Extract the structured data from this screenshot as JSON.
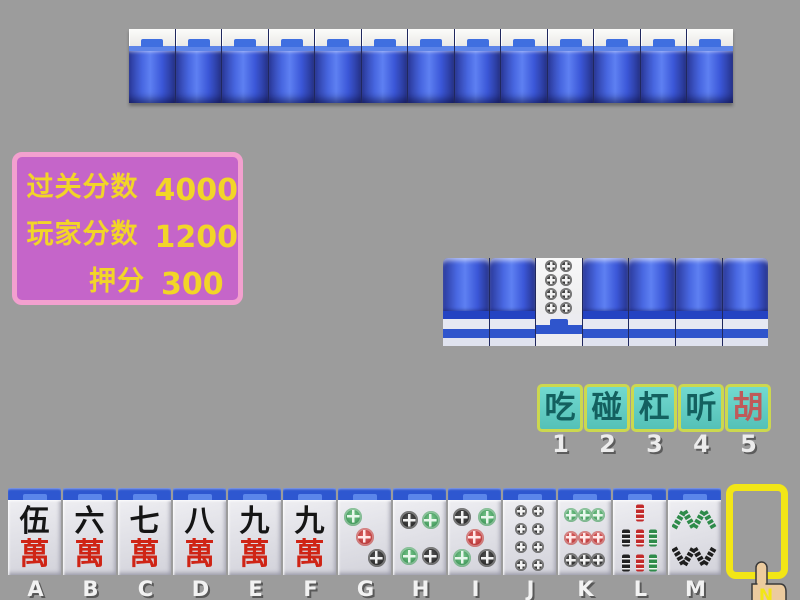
{
  "background_color": "#9c9c9c",
  "palette": {
    "green": "#2e8b4a",
    "red": "#c22a2a",
    "black": "#1d1d1d",
    "tile_blue": "#3b57d8",
    "accent_yellow": "#f2d528",
    "button_border": "#ccd84f",
    "button_fill": "#5fccc2",
    "slot_yellow": "#f2e616",
    "panel_fill": "#c565c9",
    "panel_border": "#f3a0cf"
  },
  "score_panel": {
    "rows": [
      {
        "label": "过关分数",
        "value": "4000"
      },
      {
        "label": "玩家分数",
        "value": "1200"
      },
      {
        "label": "押分",
        "value": "300"
      }
    ]
  },
  "opponent_row": {
    "tile_count": 13
  },
  "meld_row": {
    "tile_count": 7,
    "face_up_index": 3,
    "face_up": {
      "name": "8-dots",
      "dot_size": "small",
      "circles": [
        {
          "x": 33,
          "y": 15,
          "c": "black"
        },
        {
          "x": 66,
          "y": 15,
          "c": "black"
        },
        {
          "x": 33,
          "y": 40,
          "c": "black"
        },
        {
          "x": 66,
          "y": 40,
          "c": "black"
        },
        {
          "x": 33,
          "y": 65,
          "c": "black"
        },
        {
          "x": 66,
          "y": 65,
          "c": "black"
        },
        {
          "x": 33,
          "y": 90,
          "c": "black"
        },
        {
          "x": 66,
          "y": 90,
          "c": "black"
        }
      ]
    }
  },
  "action_buttons": [
    {
      "label": "吃",
      "hotkey": "1",
      "highlight": false
    },
    {
      "label": "碰",
      "hotkey": "2",
      "highlight": false
    },
    {
      "label": "杠",
      "hotkey": "3",
      "highlight": false
    },
    {
      "label": "听",
      "hotkey": "4",
      "highlight": false
    },
    {
      "label": "胡",
      "hotkey": "5",
      "highlight": true
    }
  ],
  "hand": {
    "tiles": [
      {
        "key": "A",
        "kind": "wan",
        "name": "5-wan",
        "chars": [
          "伍",
          "萬"
        ],
        "char_colors": [
          "#151515",
          "#cf2415"
        ]
      },
      {
        "key": "B",
        "kind": "wan",
        "name": "6-wan",
        "chars": [
          "六",
          "萬"
        ],
        "char_colors": [
          "#151515",
          "#cf2415"
        ]
      },
      {
        "key": "C",
        "kind": "wan",
        "name": "7-wan",
        "chars": [
          "七",
          "萬"
        ],
        "char_colors": [
          "#151515",
          "#cf2415"
        ]
      },
      {
        "key": "D",
        "kind": "wan",
        "name": "8-wan",
        "chars": [
          "八",
          "萬"
        ],
        "char_colors": [
          "#151515",
          "#cf2415"
        ]
      },
      {
        "key": "E",
        "kind": "wan",
        "name": "9-wan",
        "chars": [
          "九",
          "萬"
        ],
        "char_colors": [
          "#151515",
          "#cf2415"
        ]
      },
      {
        "key": "F",
        "kind": "wan",
        "name": "9-wan",
        "chars": [
          "九",
          "萬"
        ],
        "char_colors": [
          "#151515",
          "#cf2415"
        ]
      },
      {
        "key": "G",
        "kind": "dots",
        "name": "3-dots",
        "dot_size": "big",
        "circles": [
          {
            "x": 28,
            "y": 22,
            "c": "green"
          },
          {
            "x": 50,
            "y": 49,
            "c": "red"
          },
          {
            "x": 73,
            "y": 77,
            "c": "black"
          }
        ]
      },
      {
        "key": "H",
        "kind": "dots",
        "name": "4-dots",
        "dot_size": "big",
        "circles": [
          {
            "x": 30,
            "y": 27,
            "c": "black"
          },
          {
            "x": 71,
            "y": 27,
            "c": "green"
          },
          {
            "x": 30,
            "y": 75,
            "c": "green"
          },
          {
            "x": 71,
            "y": 75,
            "c": "black"
          }
        ]
      },
      {
        "key": "I",
        "kind": "dots",
        "name": "5-dots",
        "dot_size": "big",
        "circles": [
          {
            "x": 26,
            "y": 23,
            "c": "black"
          },
          {
            "x": 74,
            "y": 23,
            "c": "green"
          },
          {
            "x": 50,
            "y": 50,
            "c": "red"
          },
          {
            "x": 26,
            "y": 77,
            "c": "green"
          },
          {
            "x": 74,
            "y": 77,
            "c": "black"
          }
        ]
      },
      {
        "key": "J",
        "kind": "dots",
        "name": "8-dots",
        "dot_size": "small",
        "circles": [
          {
            "x": 34,
            "y": 15,
            "c": "black"
          },
          {
            "x": 66,
            "y": 15,
            "c": "black"
          },
          {
            "x": 34,
            "y": 39,
            "c": "black"
          },
          {
            "x": 66,
            "y": 39,
            "c": "black"
          },
          {
            "x": 34,
            "y": 63,
            "c": "black"
          },
          {
            "x": 66,
            "y": 63,
            "c": "black"
          },
          {
            "x": 34,
            "y": 87,
            "c": "black"
          },
          {
            "x": 66,
            "y": 87,
            "c": "black"
          }
        ]
      },
      {
        "key": "K",
        "kind": "dots",
        "name": "9-dots",
        "dot_size": "mid",
        "circles": [
          {
            "x": 24,
            "y": 20,
            "c": "green"
          },
          {
            "x": 50,
            "y": 20,
            "c": "green"
          },
          {
            "x": 76,
            "y": 20,
            "c": "green"
          },
          {
            "x": 24,
            "y": 50,
            "c": "red"
          },
          {
            "x": 50,
            "y": 50,
            "c": "red"
          },
          {
            "x": 76,
            "y": 50,
            "c": "red"
          },
          {
            "x": 24,
            "y": 80,
            "c": "black"
          },
          {
            "x": 50,
            "y": 80,
            "c": "black"
          },
          {
            "x": 76,
            "y": 80,
            "c": "black"
          }
        ]
      },
      {
        "key": "L",
        "kind": "bamboo",
        "name": "7-bamboo",
        "sticks": [
          {
            "x": 50,
            "y": 17,
            "c": "red"
          },
          {
            "x": 24,
            "y": 51,
            "c": "black"
          },
          {
            "x": 50,
            "y": 51,
            "c": "red"
          },
          {
            "x": 76,
            "y": 51,
            "c": "green"
          },
          {
            "x": 24,
            "y": 84,
            "c": "black"
          },
          {
            "x": 50,
            "y": 84,
            "c": "red"
          },
          {
            "x": 76,
            "y": 84,
            "c": "green"
          }
        ]
      },
      {
        "key": "M",
        "kind": "bamboo8",
        "name": "8-bamboo",
        "top_color": "green",
        "bottom_color": "black"
      }
    ]
  },
  "cursor": {
    "label": "N"
  }
}
